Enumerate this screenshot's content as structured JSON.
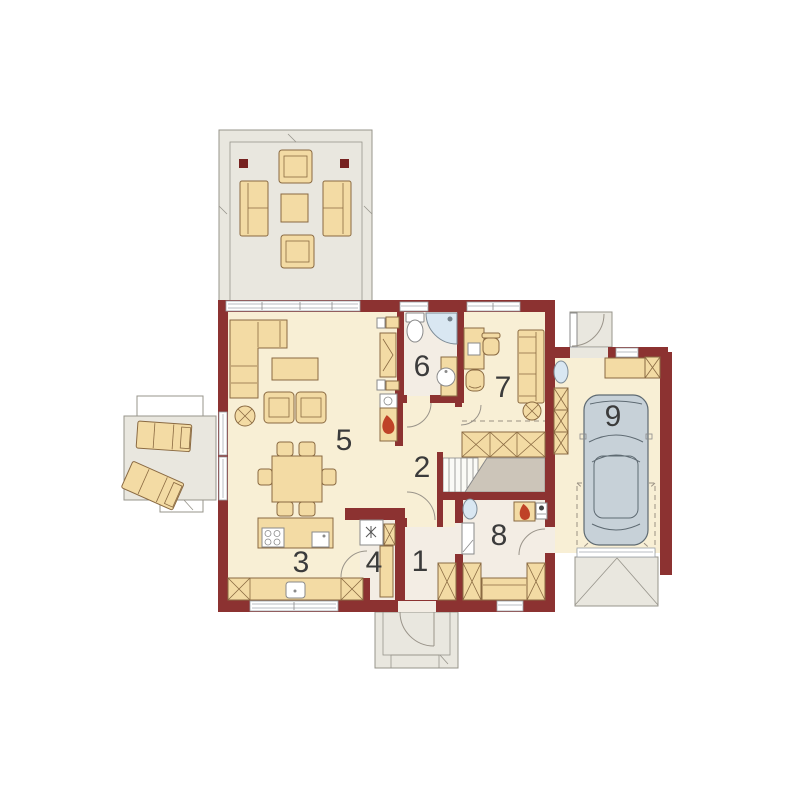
{
  "plan": {
    "rooms": [
      {
        "id": "entry",
        "number": "1"
      },
      {
        "id": "hall",
        "number": "2"
      },
      {
        "id": "kitchen",
        "number": "3"
      },
      {
        "id": "pantry",
        "number": "4"
      },
      {
        "id": "living-room",
        "number": "5"
      },
      {
        "id": "bathroom",
        "number": "6"
      },
      {
        "id": "office",
        "number": "7"
      },
      {
        "id": "utility",
        "number": "8"
      },
      {
        "id": "garage",
        "number": "9"
      }
    ],
    "colors": {
      "wall": "#8c3231",
      "post": "#762220",
      "floor": "#f8efd5",
      "floor_pale": "#f3ede4",
      "terrace": "#e9e7df",
      "outline": "#97948b",
      "furniture": "#f3dba4",
      "furniture_line": "#8a6a42",
      "stairs": "#ccc5b9",
      "dash": "#9a9184",
      "car": "#c7d1d8",
      "car_line": "#5e6a72",
      "fixture_blue": "#d9e7f2",
      "flame": "#bf4227",
      "label": "#3b3b3b"
    }
  }
}
